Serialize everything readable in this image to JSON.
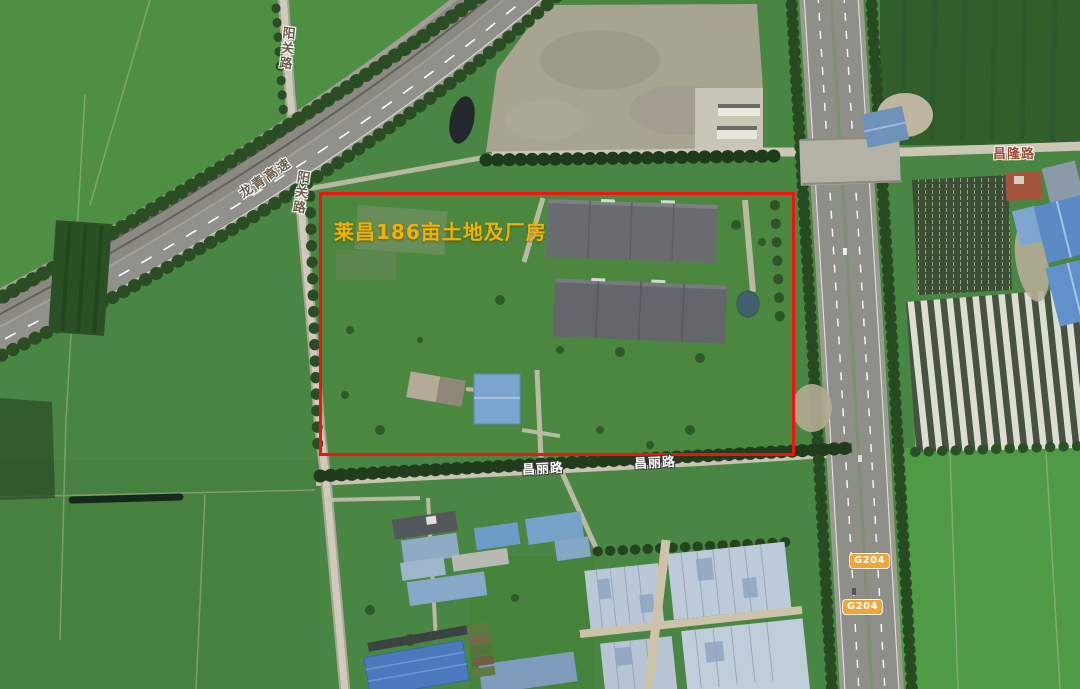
{
  "map": {
    "annotation": {
      "title": "莱昌186亩土地及厂房"
    },
    "road_labels": {
      "yangguan_top": "阳关路",
      "yangguan_mid": "阳关路",
      "longqing": "龙青高速",
      "changlong": "昌隆路",
      "changli_west": "昌丽路",
      "changli_east": "昌丽路"
    },
    "highway_shields": [
      {
        "label": "G204"
      },
      {
        "label": "G204"
      }
    ]
  },
  "colors": {
    "boundary-red": "#f3120e",
    "title-yellow": "#efb300",
    "shield-bg": "#eea63b",
    "road-label-brown": "#6b5d49",
    "changlong-label": "#a04a35"
  }
}
